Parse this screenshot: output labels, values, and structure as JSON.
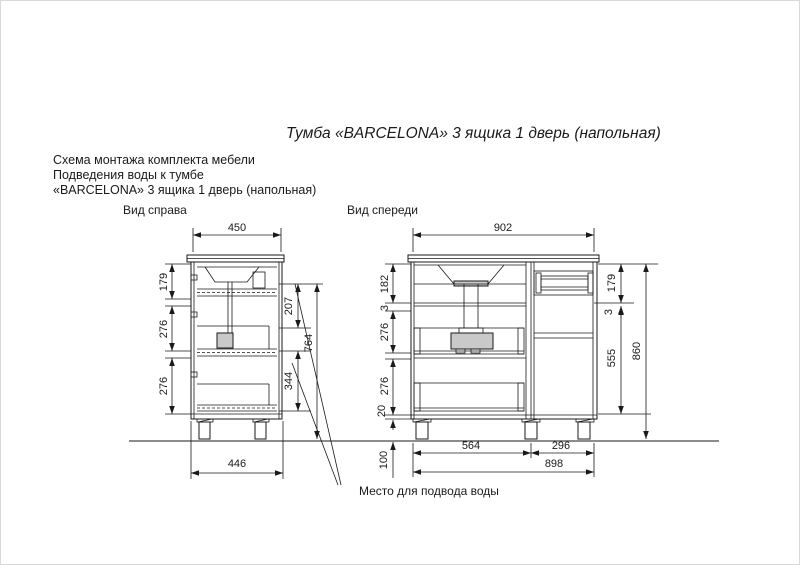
{
  "page": {
    "title": "Тумба «BARCELONA» 3 ящика 1 дверь (напольная)",
    "subtitle_1": "Схема монтажа комплекта мебели",
    "subtitle_2": "Подведения воды к тумбе",
    "subtitle_3": "«BARCELONA» 3 ящика 1 дверь (напольная)",
    "annotation": "Место для подвода воды"
  },
  "side_view": {
    "label": "Вид справа",
    "dim_top_width": "450",
    "dim_left_1": "179",
    "dim_left_2": "276",
    "dim_left_3": "276",
    "dim_right_1": "207",
    "dim_right_2": "344",
    "dim_right_overall": "764",
    "dim_bottom_width": "446"
  },
  "front_view": {
    "label": "Вид спереди",
    "dim_top_width": "902",
    "dim_left_1": "182",
    "dim_left_2": "3",
    "dim_left_3": "276",
    "dim_left_4": "276",
    "dim_left_5": "20",
    "dim_right_1": "179",
    "dim_right_2": "3",
    "dim_right_3": "555",
    "dim_right_overall": "860",
    "dim_bottom_left": "564",
    "dim_bottom_right": "296",
    "dim_bottom_total": "898",
    "dim_supply_height": "100"
  },
  "colors": {
    "line": "#1a1a1a",
    "shade": "#c9c9c9"
  }
}
